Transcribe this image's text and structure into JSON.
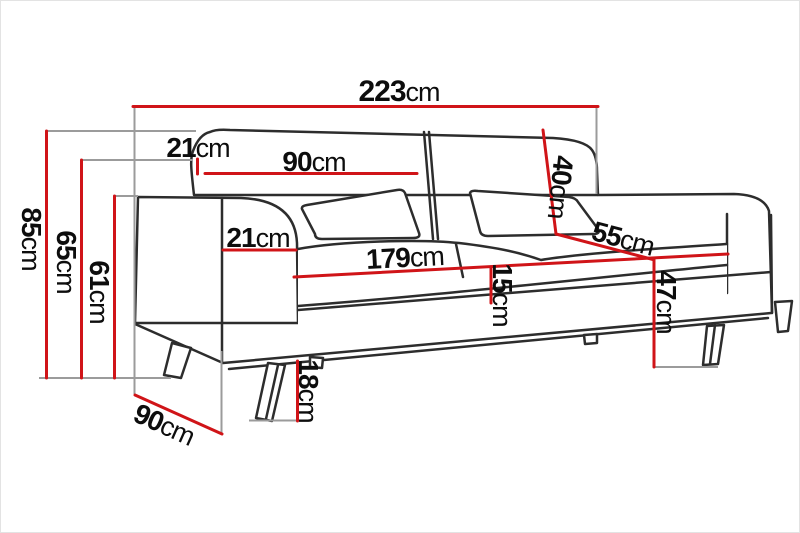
{
  "diagram": {
    "title": "sofa-dimension-diagram",
    "unit_system": "cm",
    "dimensions": {
      "total_width": {
        "value": "223",
        "unit": "cm"
      },
      "back_cushion_offset": {
        "value": "21",
        "unit": "cm"
      },
      "back_cushion_width": {
        "value": "90",
        "unit": "cm"
      },
      "total_height": {
        "value": "85",
        "unit": "cm"
      },
      "back_height": {
        "value": "65",
        "unit": "cm"
      },
      "arm_height": {
        "value": "61",
        "unit": "cm"
      },
      "arm_width": {
        "value": "21",
        "unit": "cm"
      },
      "seat_width": {
        "value": "179",
        "unit": "cm"
      },
      "seat_cushion_thickness": {
        "value": "15",
        "unit": "cm"
      },
      "backrest_cushion_height": {
        "value": "40",
        "unit": "cm"
      },
      "seat_depth": {
        "value": "55",
        "unit": "cm"
      },
      "seat_height": {
        "value": "47",
        "unit": "cm"
      },
      "leg_height": {
        "value": "18",
        "unit": "cm"
      },
      "total_depth": {
        "value": "90",
        "unit": "cm"
      }
    },
    "colors": {
      "dimension_line": "#d01418",
      "extension_line": "#9b9b9b",
      "outline": "#2d2d2d",
      "background": "#ffffff"
    }
  }
}
